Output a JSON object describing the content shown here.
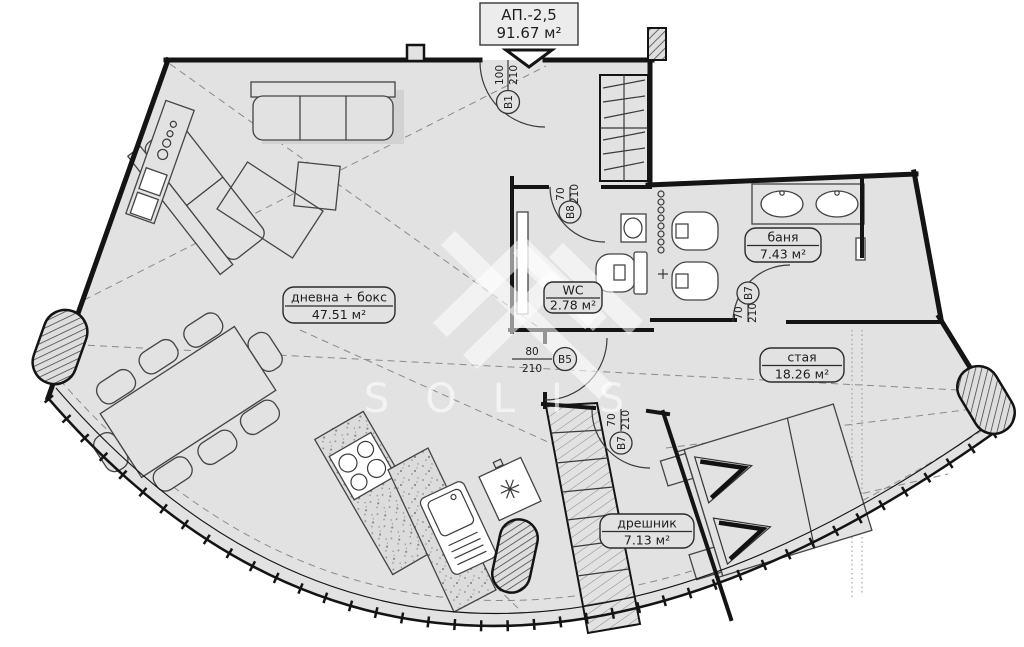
{
  "title": {
    "apartment": "АП.-2,5",
    "area": "91.67 м²"
  },
  "watermark": {
    "brand": "SOLIS"
  },
  "rooms": {
    "living": {
      "name": "дневна + бокс",
      "area": "47.51 м²"
    },
    "wc": {
      "name": "WC",
      "area": "2.78 м²"
    },
    "bath": {
      "name": "баня",
      "area": "7.43 м²"
    },
    "bedroom": {
      "name": "стая",
      "area": "18.26 м²"
    },
    "closet": {
      "name": "дрешник",
      "area": "7.13 м²"
    }
  },
  "doors": {
    "b1": {
      "id": "В1",
      "width": "100",
      "height": "210"
    },
    "b8": {
      "id": "В8",
      "width": "70",
      "height": "210"
    },
    "b7_bath": {
      "id": "В7",
      "width": "70",
      "height": "210"
    },
    "b5": {
      "id": "В5",
      "width": "80",
      "height": "210"
    },
    "b7_bed": {
      "id": "В7",
      "width": "70",
      "height": "210"
    }
  },
  "colors": {
    "floor": "#e2e2e2",
    "wall": "#141414",
    "label_ink": "#1d1d1d"
  }
}
